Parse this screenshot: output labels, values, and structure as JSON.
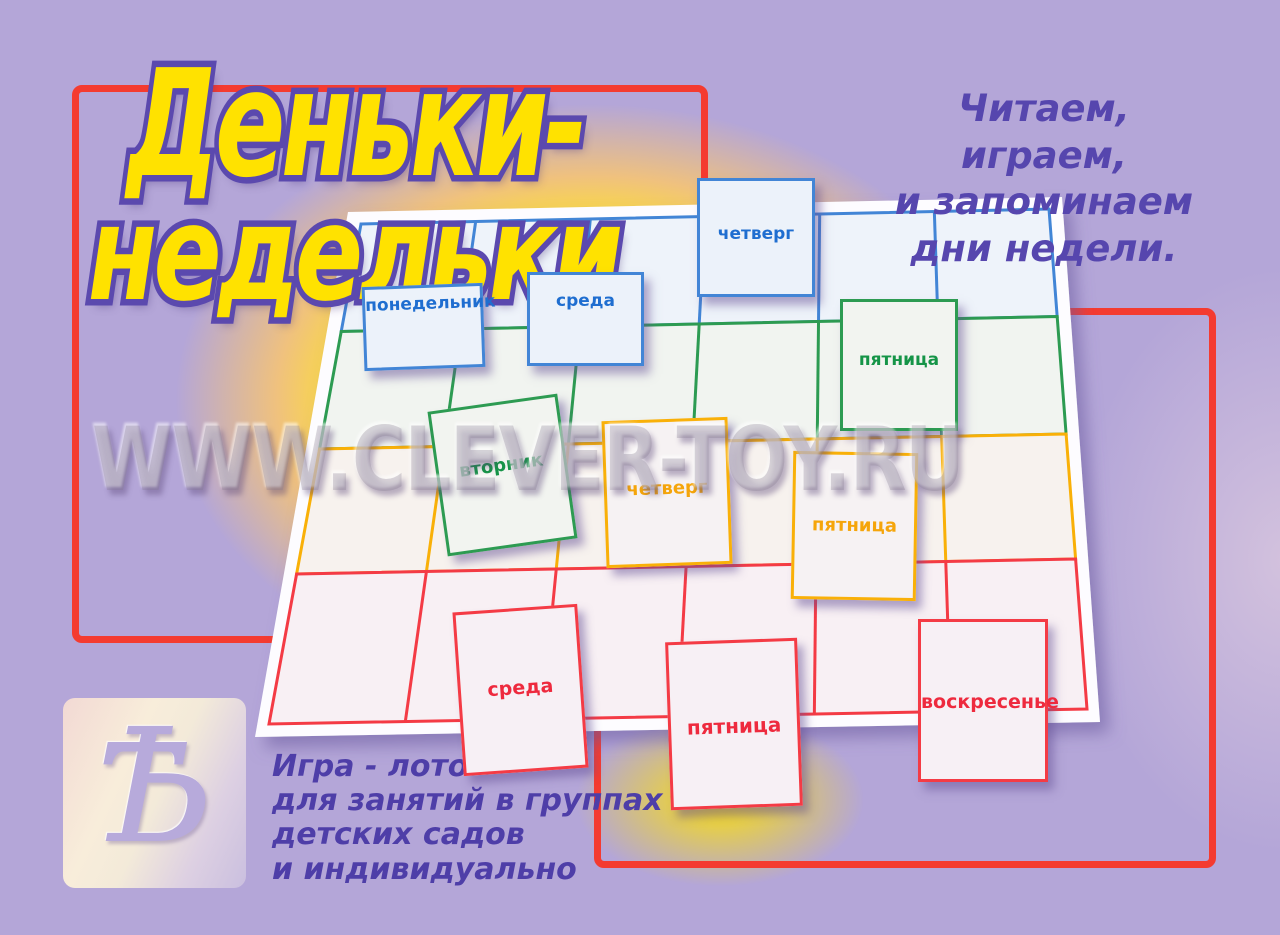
{
  "title": {
    "line1": "Деньки-",
    "line2": "недельки"
  },
  "tagline": {
    "lines": [
      "Читаем, играем,",
      "и запоминаем",
      "дни недели."
    ]
  },
  "description": {
    "lines": [
      "Игра - лото",
      "для занятий в группах",
      "детских садов",
      "и индивидуально"
    ]
  },
  "watermark": "WWW.CLEVER-TOY.RU",
  "logo": {
    "glyph": "Ѣ"
  },
  "board": {
    "columns": 6,
    "rows": [
      {
        "color_name": "blue",
        "hex": "#4285d6",
        "tint": "#eef3fa"
      },
      {
        "color_name": "green",
        "hex": "#2d9b52",
        "tint": "#f1f4f0"
      },
      {
        "color_name": "yellow",
        "hex": "#f9b008",
        "tint": "#f7f2ee"
      },
      {
        "color_name": "red",
        "hex": "#f43b45",
        "tint": "#f8f0f4"
      }
    ]
  },
  "cards": [
    {
      "label": "понедельник",
      "color": "blue"
    },
    {
      "label": "среда",
      "color": "blue"
    },
    {
      "label": "четверг",
      "color": "blue"
    },
    {
      "label": "пятница",
      "color": "green"
    },
    {
      "label": "вторник",
      "color": "green"
    },
    {
      "label": "четверг",
      "color": "yellow"
    },
    {
      "label": "пятница",
      "color": "yellow"
    },
    {
      "label": "среда",
      "color": "red"
    },
    {
      "label": "пятница",
      "color": "red"
    },
    {
      "label": "воскресенье",
      "color": "red"
    }
  ],
  "colors": {
    "background": "#b4a6d8",
    "glow": "#ffe203",
    "frame_red": "#f43b30",
    "title_fill": "#ffe200",
    "title_outline": "#5b49ae",
    "text_purple": "#5646ae"
  }
}
